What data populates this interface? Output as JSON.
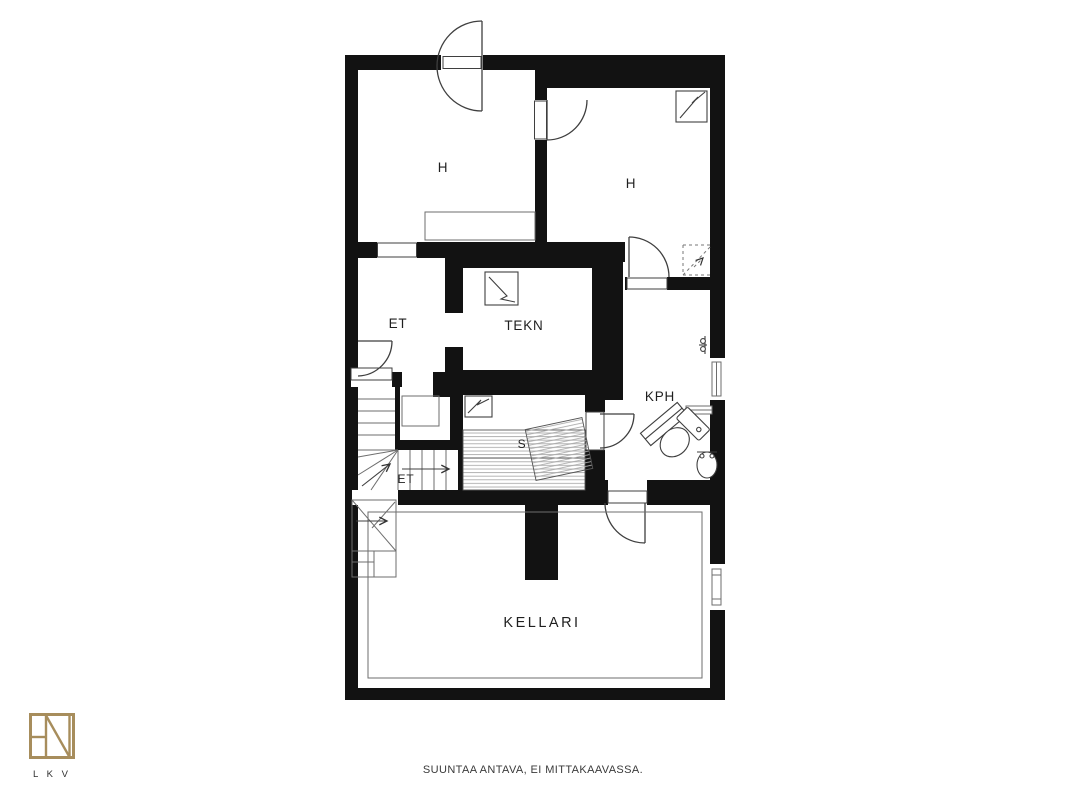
{
  "plan": {
    "labels": {
      "room_h_left": "H",
      "room_h_right": "H",
      "entry_hall": "ET",
      "technical_room": "TEKN",
      "bathroom": "KPH",
      "sauna": "S",
      "stair_hall": "ET",
      "cellar": "KELLARI"
    }
  },
  "footer": {
    "disclaimer": "SUUNTAA ANTAVA, EI MITTAKAAVASSA."
  },
  "logo": {
    "caption": "L K V"
  },
  "colors": {
    "wall": "#121212",
    "line": "#3f3f3f",
    "thin": "#6e6e6e",
    "hatch": "#b3b3b3",
    "logo_gold": "#a78d5c",
    "text": "#1f1f1f"
  }
}
